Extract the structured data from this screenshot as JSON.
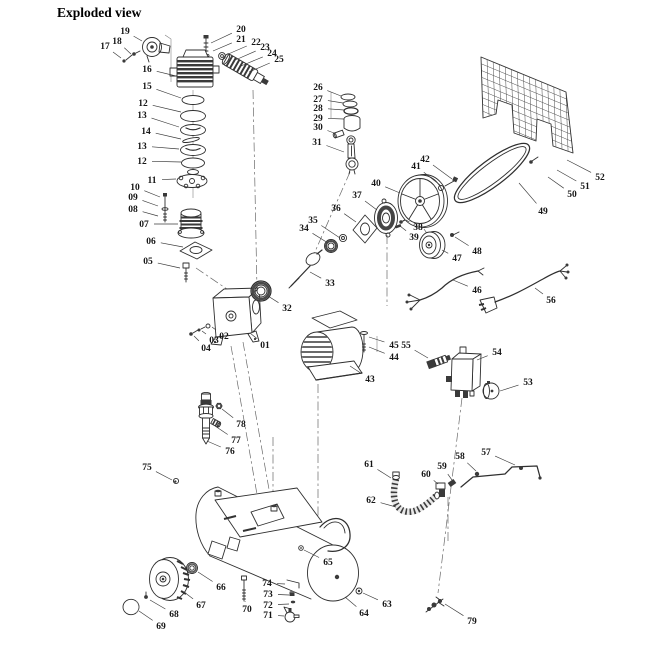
{
  "title": "Exploded view",
  "colors": {
    "background": "#ffffff",
    "line_art": "#2f2f2f",
    "label_text": "#161616"
  },
  "diagram": {
    "type": "exploded-parts-diagram",
    "labels": [
      {
        "text": "01",
        "x": 265,
        "y": 345,
        "ex": 250,
        "ey": 333
      },
      {
        "text": "02",
        "x": 224,
        "y": 336,
        "ex": 212,
        "ey": 327
      },
      {
        "text": "03",
        "x": 214,
        "y": 340,
        "ex": 202,
        "ey": 331
      },
      {
        "text": "04",
        "x": 206,
        "y": 348,
        "ex": 194,
        "ey": 336
      },
      {
        "text": "05",
        "x": 148,
        "y": 261,
        "ex": 180,
        "ey": 268
      },
      {
        "text": "06",
        "x": 151,
        "y": 241,
        "ex": 183,
        "ey": 247
      },
      {
        "text": "07",
        "x": 144,
        "y": 224,
        "ex": 178,
        "ey": 224
      },
      {
        "text": "08",
        "x": 133,
        "y": 209,
        "ex": 158,
        "ey": 216
      },
      {
        "text": "09",
        "x": 133,
        "y": 197,
        "ex": 158,
        "ey": 206
      },
      {
        "text": "10",
        "x": 135,
        "y": 187,
        "ex": 160,
        "ey": 197
      },
      {
        "text": "11",
        "x": 152,
        "y": 180,
        "ex": 176,
        "ey": 179
      },
      {
        "text": "12",
        "x": 143,
        "y": 103,
        "ex": 181,
        "ey": 112
      },
      {
        "text": "13",
        "x": 142,
        "y": 115,
        "ex": 179,
        "ey": 127
      },
      {
        "text": "14",
        "x": 146,
        "y": 131,
        "ex": 181,
        "ey": 139
      },
      {
        "text": "13",
        "x": 142,
        "y": 146,
        "ex": 179,
        "ey": 149
      },
      {
        "text": "12",
        "x": 142,
        "y": 161,
        "ex": 181,
        "ey": 162
      },
      {
        "text": "15",
        "x": 147,
        "y": 86,
        "ex": 181,
        "ey": 98
      },
      {
        "text": "16",
        "x": 147,
        "y": 69,
        "ex": 176,
        "ey": 76
      },
      {
        "text": "17",
        "x": 105,
        "y": 46,
        "ex": 121,
        "ey": 58
      },
      {
        "text": "18",
        "x": 117,
        "y": 41,
        "ex": 131,
        "ey": 54
      },
      {
        "text": "19",
        "x": 125,
        "y": 31,
        "ex": 142,
        "ey": 41
      },
      {
        "text": "20",
        "x": 241,
        "y": 29,
        "ex": 211,
        "ey": 43
      },
      {
        "text": "21",
        "x": 241,
        "y": 39,
        "ex": 213,
        "ey": 51
      },
      {
        "text": "22",
        "x": 256,
        "y": 42,
        "ex": 226,
        "ey": 55
      },
      {
        "text": "23",
        "x": 265,
        "y": 47,
        "ex": 233,
        "ey": 61
      },
      {
        "text": "24",
        "x": 272,
        "y": 53,
        "ex": 241,
        "ey": 66
      },
      {
        "text": "25",
        "x": 279,
        "y": 59,
        "ex": 249,
        "ey": 72
      },
      {
        "text": "26",
        "x": 318,
        "y": 87,
        "ex": 341,
        "ey": 96
      },
      {
        "text": "27",
        "x": 318,
        "y": 99,
        "ex": 343,
        "ey": 103
      },
      {
        "text": "28",
        "x": 318,
        "y": 108,
        "ex": 344,
        "ey": 110
      },
      {
        "text": "29",
        "x": 318,
        "y": 118,
        "ex": 344,
        "ey": 119
      },
      {
        "text": "30",
        "x": 318,
        "y": 127,
        "ex": 334,
        "ey": 133
      },
      {
        "text": "31",
        "x": 317,
        "y": 142,
        "ex": 344,
        "ey": 152
      },
      {
        "text": "32",
        "x": 287,
        "y": 308,
        "ex": 268,
        "ey": 296
      },
      {
        "text": "33",
        "x": 330,
        "y": 283,
        "ex": 310,
        "ey": 272
      },
      {
        "text": "34",
        "x": 304,
        "y": 228,
        "ex": 328,
        "ey": 243
      },
      {
        "text": "35",
        "x": 313,
        "y": 220,
        "ex": 340,
        "ey": 238
      },
      {
        "text": "36",
        "x": 336,
        "y": 208,
        "ex": 356,
        "ey": 222
      },
      {
        "text": "37",
        "x": 357,
        "y": 195,
        "ex": 377,
        "ey": 210
      },
      {
        "text": "38",
        "x": 418,
        "y": 227,
        "ex": 406,
        "ey": 220
      },
      {
        "text": "39",
        "x": 414,
        "y": 237,
        "ex": 400,
        "ey": 226
      },
      {
        "text": "40",
        "x": 376,
        "y": 183,
        "ex": 400,
        "ey": 193
      },
      {
        "text": "41",
        "x": 416,
        "y": 166,
        "ex": 440,
        "ey": 185
      },
      {
        "text": "42",
        "x": 425,
        "y": 159,
        "ex": 452,
        "ey": 179
      },
      {
        "text": "43",
        "x": 370,
        "y": 379,
        "ex": 350,
        "ey": 366
      },
      {
        "text": "44",
        "x": 394,
        "y": 357,
        "ex": 369,
        "ey": 347
      },
      {
        "text": "45",
        "x": 394,
        "y": 345,
        "ex": 369,
        "ey": 337
      },
      {
        "text": "46",
        "x": 477,
        "y": 290,
        "ex": 453,
        "ey": 280
      },
      {
        "text": "47",
        "x": 457,
        "y": 258,
        "ex": 442,
        "ey": 250
      },
      {
        "text": "48",
        "x": 477,
        "y": 251,
        "ex": 455,
        "ey": 237
      },
      {
        "text": "49",
        "x": 543,
        "y": 211,
        "ex": 519,
        "ey": 183
      },
      {
        "text": "50",
        "x": 572,
        "y": 194,
        "ex": 548,
        "ey": 177
      },
      {
        "text": "51",
        "x": 585,
        "y": 186,
        "ex": 557,
        "ey": 170
      },
      {
        "text": "52",
        "x": 600,
        "y": 177,
        "ex": 567,
        "ey": 160
      },
      {
        "text": "53",
        "x": 528,
        "y": 382,
        "ex": 500,
        "ey": 391
      },
      {
        "text": "54",
        "x": 497,
        "y": 352,
        "ex": 477,
        "ey": 360
      },
      {
        "text": "55",
        "x": 406,
        "y": 345,
        "ex": 428,
        "ey": 358
      },
      {
        "text": "56",
        "x": 551,
        "y": 300,
        "ex": 535,
        "ey": 288
      },
      {
        "text": "57",
        "x": 486,
        "y": 452,
        "ex": 515,
        "ey": 465
      },
      {
        "text": "58",
        "x": 460,
        "y": 456,
        "ex": 476,
        "ey": 471
      },
      {
        "text": "59",
        "x": 442,
        "y": 466,
        "ex": 452,
        "ey": 480
      },
      {
        "text": "60",
        "x": 426,
        "y": 474,
        "ex": 438,
        "ey": 484
      },
      {
        "text": "61",
        "x": 369,
        "y": 464,
        "ex": 391,
        "ey": 478
      },
      {
        "text": "62",
        "x": 371,
        "y": 500,
        "ex": 396,
        "ey": 507
      },
      {
        "text": "63",
        "x": 387,
        "y": 604,
        "ex": 363,
        "ey": 593
      },
      {
        "text": "64",
        "x": 364,
        "y": 613,
        "ex": 345,
        "ey": 597
      },
      {
        "text": "65",
        "x": 328,
        "y": 562,
        "ex": 304,
        "ey": 550
      },
      {
        "text": "66",
        "x": 221,
        "y": 587,
        "ex": 198,
        "ey": 572
      },
      {
        "text": "67",
        "x": 201,
        "y": 605,
        "ex": 184,
        "ey": 592
      },
      {
        "text": "68",
        "x": 174,
        "y": 614,
        "ex": 150,
        "ey": 600
      },
      {
        "text": "69",
        "x": 161,
        "y": 626,
        "ex": 139,
        "ey": 611
      },
      {
        "text": "70",
        "x": 247,
        "y": 609,
        "ex": 245,
        "ey": 601
      },
      {
        "text": "71",
        "x": 268,
        "y": 615,
        "ex": 284,
        "ey": 616
      },
      {
        "text": "72",
        "x": 268,
        "y": 605,
        "ex": 289,
        "ey": 604
      },
      {
        "text": "73",
        "x": 268,
        "y": 594,
        "ex": 289,
        "ey": 595
      },
      {
        "text": "74",
        "x": 267,
        "y": 583,
        "ex": 285,
        "ey": 584
      },
      {
        "text": "75",
        "x": 147,
        "y": 467,
        "ex": 172,
        "ey": 480
      },
      {
        "text": "76",
        "x": 230,
        "y": 451,
        "ex": 207,
        "ey": 441
      },
      {
        "text": "77",
        "x": 236,
        "y": 440,
        "ex": 215,
        "ey": 426
      },
      {
        "text": "78",
        "x": 241,
        "y": 424,
        "ex": 222,
        "ey": 409
      },
      {
        "text": "79",
        "x": 472,
        "y": 621,
        "ex": 445,
        "ey": 604
      }
    ]
  }
}
